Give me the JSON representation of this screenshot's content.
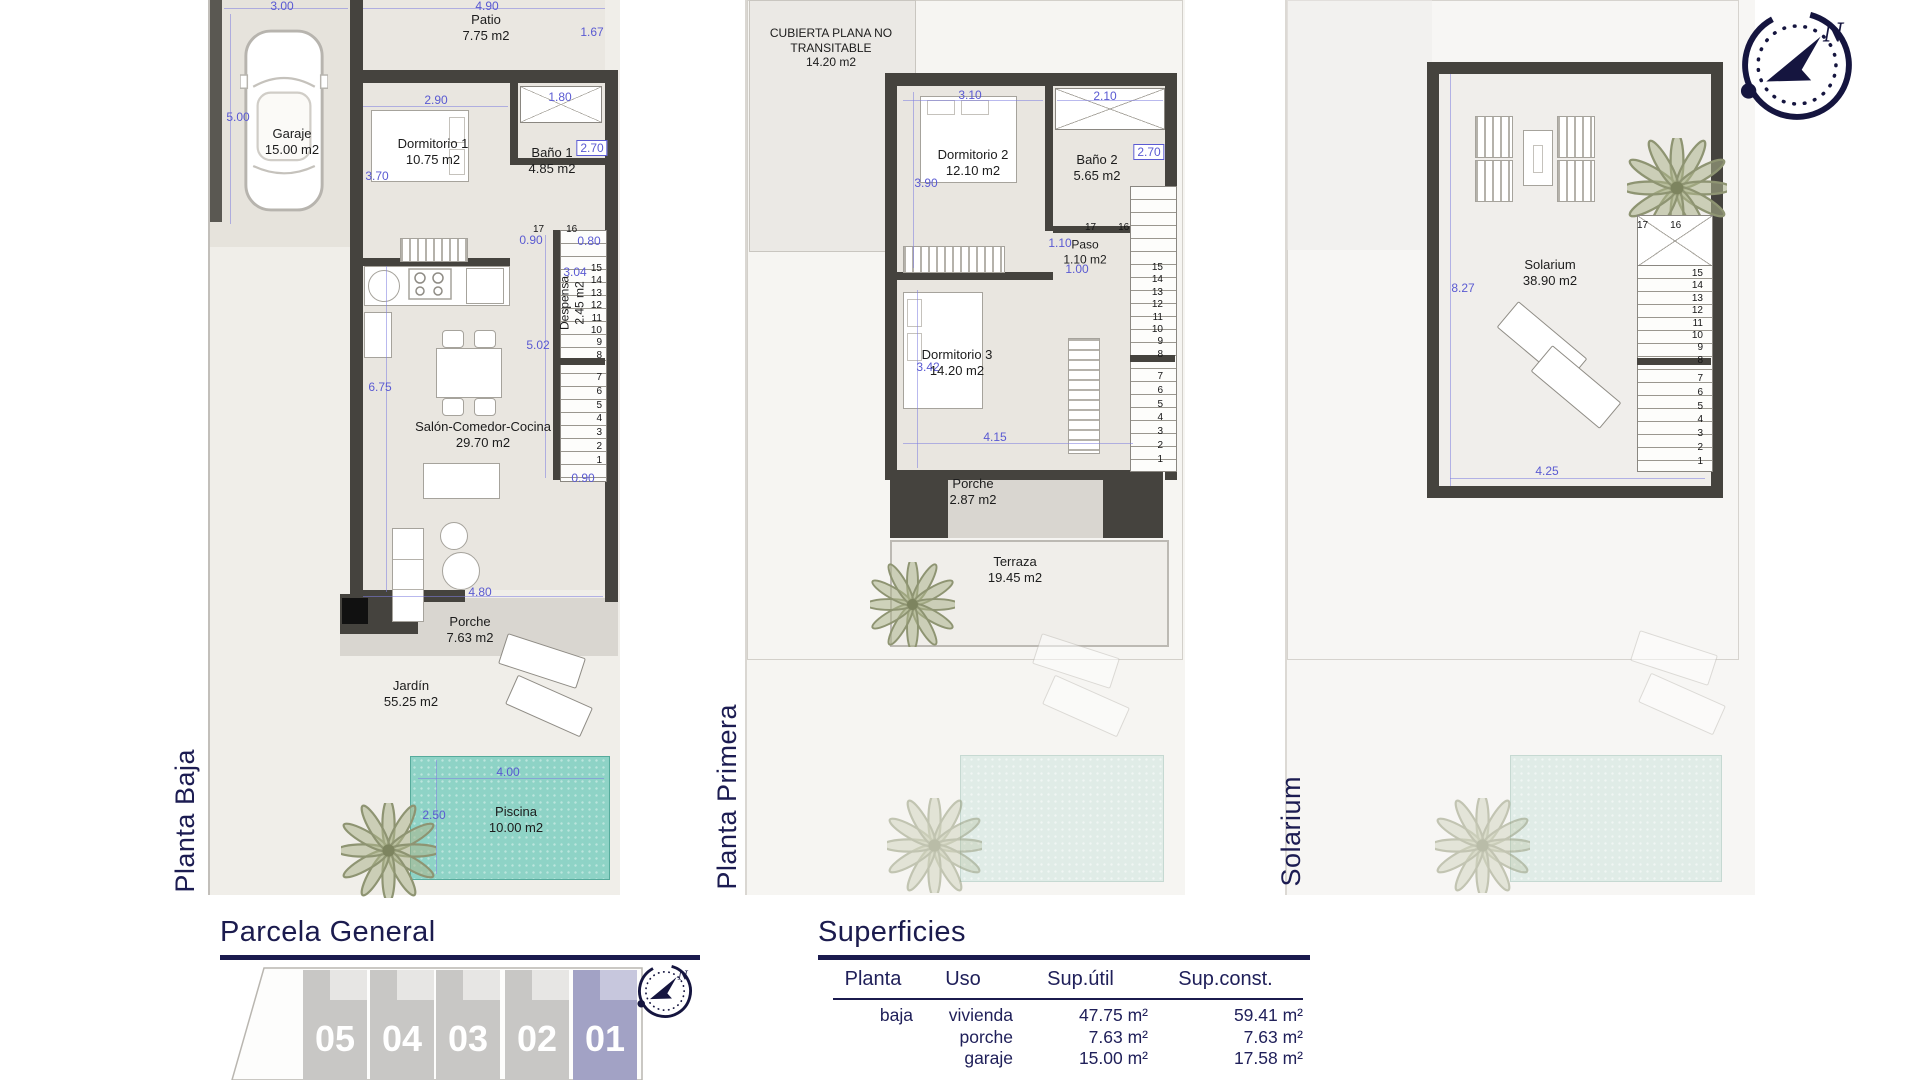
{
  "floor_titles": [
    "Planta Baja",
    "Planta Primera",
    "Solarium"
  ],
  "compass": {
    "north_label": "N"
  },
  "plan_baja": {
    "rooms": {
      "garaje": {
        "name": "Garaje",
        "area": "15.00 m2"
      },
      "patio": {
        "name": "Patio",
        "area": "7.75 m2"
      },
      "dormitorio1": {
        "name": "Dormitorio 1",
        "area": "10.75 m2"
      },
      "bano1": {
        "name": "Baño 1",
        "area": "4.85 m2"
      },
      "despensa": {
        "name": "Despensa",
        "area": "2.45 m2"
      },
      "salon": {
        "name": "Salón-Comedor-Cocina",
        "area": "29.70 m2"
      },
      "porche": {
        "name": "Porche",
        "area": "7.63 m2"
      },
      "jardin": {
        "name": "Jardín",
        "area": "55.25 m2"
      },
      "piscina": {
        "name": "Piscina",
        "area": "10.00 m2"
      }
    },
    "dims": {
      "garaje_ancho": "3.00",
      "garaje_fondo": "5.00",
      "patio_ancho": "4.90",
      "patio_alto": "1.67",
      "dorm1_ancho": "2.90",
      "dorm1_alto": "3.70",
      "bano1_ancho": "1.80",
      "bano1_alto": "2.70",
      "paso": "0.90",
      "escalera": "0.80",
      "despensa_alto": "3.04",
      "salon_alto": "5.02",
      "salon_alto2": "6.75",
      "salon_ancho": "4.80",
      "escalera_bajo": "0.90",
      "piscina_ancho": "4.00",
      "piscina_alto": "2.50"
    },
    "stairs": {
      "top": [
        "17",
        "16"
      ],
      "upper": [
        "15",
        "14",
        "13",
        "12",
        "11",
        "10",
        "9",
        "8"
      ],
      "lower": [
        "7",
        "6",
        "5",
        "4",
        "3",
        "2",
        "1"
      ]
    }
  },
  "plan_primera": {
    "rooms": {
      "cubierta": {
        "name": "CUBIERTA PLANA NO TRANSITABLE",
        "area": "14.20 m2"
      },
      "dormitorio2": {
        "name": "Dormitorio 2",
        "area": "12.10 m2"
      },
      "bano2": {
        "name": "Baño 2",
        "area": "5.65 m2"
      },
      "paso": {
        "name": "Paso",
        "area": "1.10 m2"
      },
      "dormitorio3": {
        "name": "Dormitorio 3",
        "area": "14.20 m2"
      },
      "porche": {
        "name": "Porche",
        "area": "2.87 m2"
      },
      "terraza": {
        "name": "Terraza",
        "area": "19.45 m2"
      }
    },
    "dims": {
      "dorm2_ancho": "3.10",
      "bano2_ancho": "2.10",
      "dorm2_alto": "3.90",
      "bano2_alto": "2.70",
      "paso_alto": "1.10",
      "paso_ancho": "1.00",
      "dorm3_alto": "3.42",
      "dorm3_ancho": "4.15"
    },
    "stairs": {
      "top": [
        "17",
        "16"
      ],
      "upper": [
        "15",
        "14",
        "13",
        "12",
        "11",
        "10",
        "9",
        "8"
      ],
      "lower": [
        "7",
        "6",
        "5",
        "4",
        "3",
        "2",
        "1"
      ]
    }
  },
  "plan_solarium": {
    "rooms": {
      "solarium": {
        "name": "Solarium",
        "area": "38.90 m2"
      }
    },
    "dims": {
      "alto": "8.27",
      "ancho": "4.25"
    },
    "stairs": {
      "top": [
        "17",
        "16"
      ],
      "upper": [
        "15",
        "14",
        "13",
        "12",
        "11",
        "10",
        "9",
        "8"
      ],
      "lower": [
        "7",
        "6",
        "5",
        "4",
        "3",
        "2",
        "1"
      ]
    }
  },
  "parcela": {
    "title": "Parcela General",
    "plots": [
      "05",
      "04",
      "03",
      "02",
      "01"
    ],
    "highlighted_plot": "01"
  },
  "superficies": {
    "title": "Superficies",
    "headers": [
      "Planta",
      "Uso",
      "Sup.útil",
      "Sup.const."
    ],
    "rows": [
      {
        "planta": "baja",
        "uso": "vivienda",
        "util": "47.75 m²",
        "const": "59.41 m²"
      },
      {
        "planta": "",
        "uso": "porche",
        "util": "7.63 m²",
        "const": "7.63 m²"
      },
      {
        "planta": "",
        "uso": "garaje",
        "util": "15.00 m²",
        "const": "17.58 m²"
      },
      {
        "planta": "primera",
        "uso": "vivienda",
        "util": "33.05 m²",
        "const": "45.53 m²"
      }
    ]
  },
  "colors": {
    "navy": "#1b1b4e",
    "dim_blue": "#5a5ad2",
    "wall": "#45433e",
    "pool": "#8ed3c6",
    "plot_gray": "#c8c7c5",
    "plot_highlight": "#a2a2c5"
  }
}
